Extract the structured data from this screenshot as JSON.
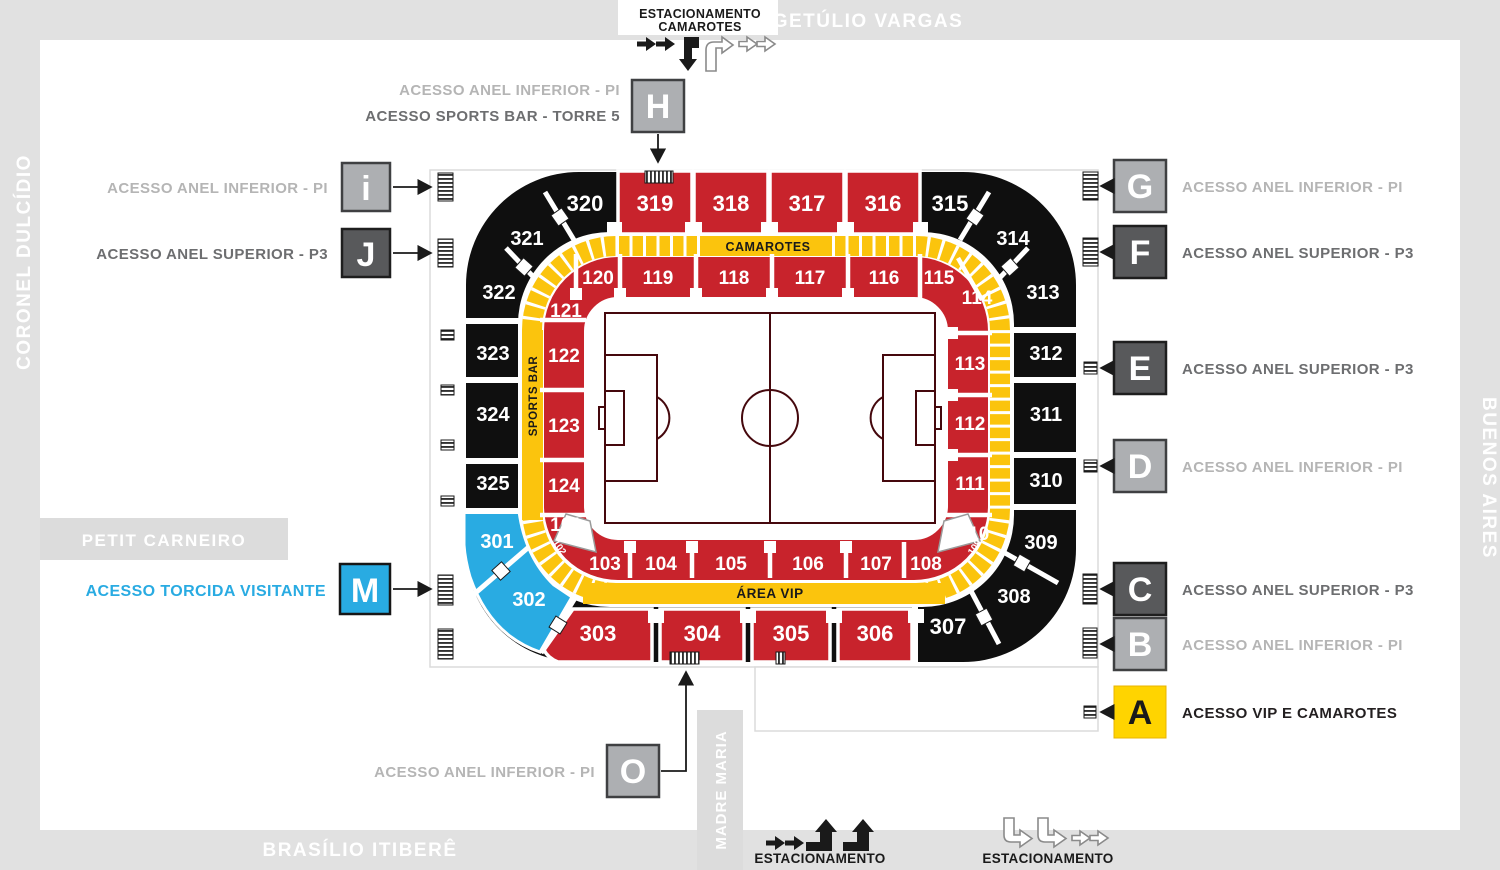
{
  "streets": {
    "top": "GETÚLIO VARGAS",
    "left": "CORONEL DULCÍDIO",
    "right": "BUENOS AIRES",
    "bottom": "BRASÍLIO ITIBERÊ",
    "bottom_vertical": "MADRE MARIA",
    "petit": "PETIT CARNEIRO"
  },
  "parking": {
    "top_line1": "ESTACIONAMENTO",
    "top_line2": "CAMAROTES",
    "bottom_left": "ESTACIONAMENTO",
    "bottom_right": "ESTACIONAMENTO"
  },
  "ring": {
    "camarotes": "CAMAROTES",
    "area_vip": "ÁREA VIP",
    "sports_bar": "SPORTS BAR"
  },
  "gates": {
    "H": {
      "letter": "H",
      "label1": "ACESSO ANEL INFERIOR - PI",
      "label2": "ACESSO SPORTS BAR - TORRE 5"
    },
    "i": {
      "letter": "i",
      "label": "ACESSO ANEL INFERIOR - PI"
    },
    "J": {
      "letter": "J",
      "label": "ACESSO ANEL SUPERIOR - P3"
    },
    "M": {
      "letter": "M",
      "label": "ACESSO TORCIDA VISITANTE"
    },
    "O": {
      "letter": "O",
      "label": "ACESSO ANEL INFERIOR - PI"
    },
    "G": {
      "letter": "G",
      "label": "ACESSO ANEL INFERIOR - PI"
    },
    "F": {
      "letter": "F",
      "label": "ACESSO ANEL SUPERIOR - P3"
    },
    "E": {
      "letter": "E",
      "label": "ACESSO ANEL SUPERIOR - P3"
    },
    "D": {
      "letter": "D",
      "label": "ACESSO ANEL INFERIOR - PI"
    },
    "C": {
      "letter": "C",
      "label": "ACESSO ANEL SUPERIOR - P3"
    },
    "B": {
      "letter": "B",
      "label": "ACESSO ANEL INFERIOR - PI"
    },
    "A": {
      "letter": "A",
      "label": "ACESSO VIP E CAMAROTES"
    }
  },
  "sec": {
    "101": "101",
    "102": "102",
    "103": "103",
    "104": "104",
    "105": "105",
    "106": "106",
    "107": "107",
    "108": "108",
    "109": "109",
    "110": "110",
    "111": "111",
    "112": "112",
    "113": "113",
    "114": "114",
    "115": "115",
    "116": "116",
    "117": "117",
    "118": "118",
    "119": "119",
    "120": "120",
    "121": "121",
    "122": "122",
    "123": "123",
    "124": "124",
    "301": "301",
    "302": "302",
    "303": "303",
    "304": "304",
    "305": "305",
    "306": "306",
    "307": "307",
    "308": "308",
    "309": "309",
    "310": "310",
    "311": "311",
    "312": "312",
    "313": "313",
    "314": "314",
    "315": "315",
    "316": "316",
    "317": "317",
    "318": "318",
    "319": "319",
    "320": "320",
    "321": "321",
    "322": "322",
    "323": "323",
    "324": "324",
    "325": "325"
  },
  "colors": {
    "section_red": "#C8232C",
    "section_black": "#0F0F0F",
    "ring_yellow": "#FBC40D",
    "visitor_blue": "#29ABE2",
    "band_gray": "#E1E1E1",
    "box_light_gray": "#ADAFB2",
    "box_dark_gray": "#58595B",
    "vip_yellow": "#FFD400",
    "label_light": "#B5B5B5",
    "label_dark": "#6D6E70"
  }
}
